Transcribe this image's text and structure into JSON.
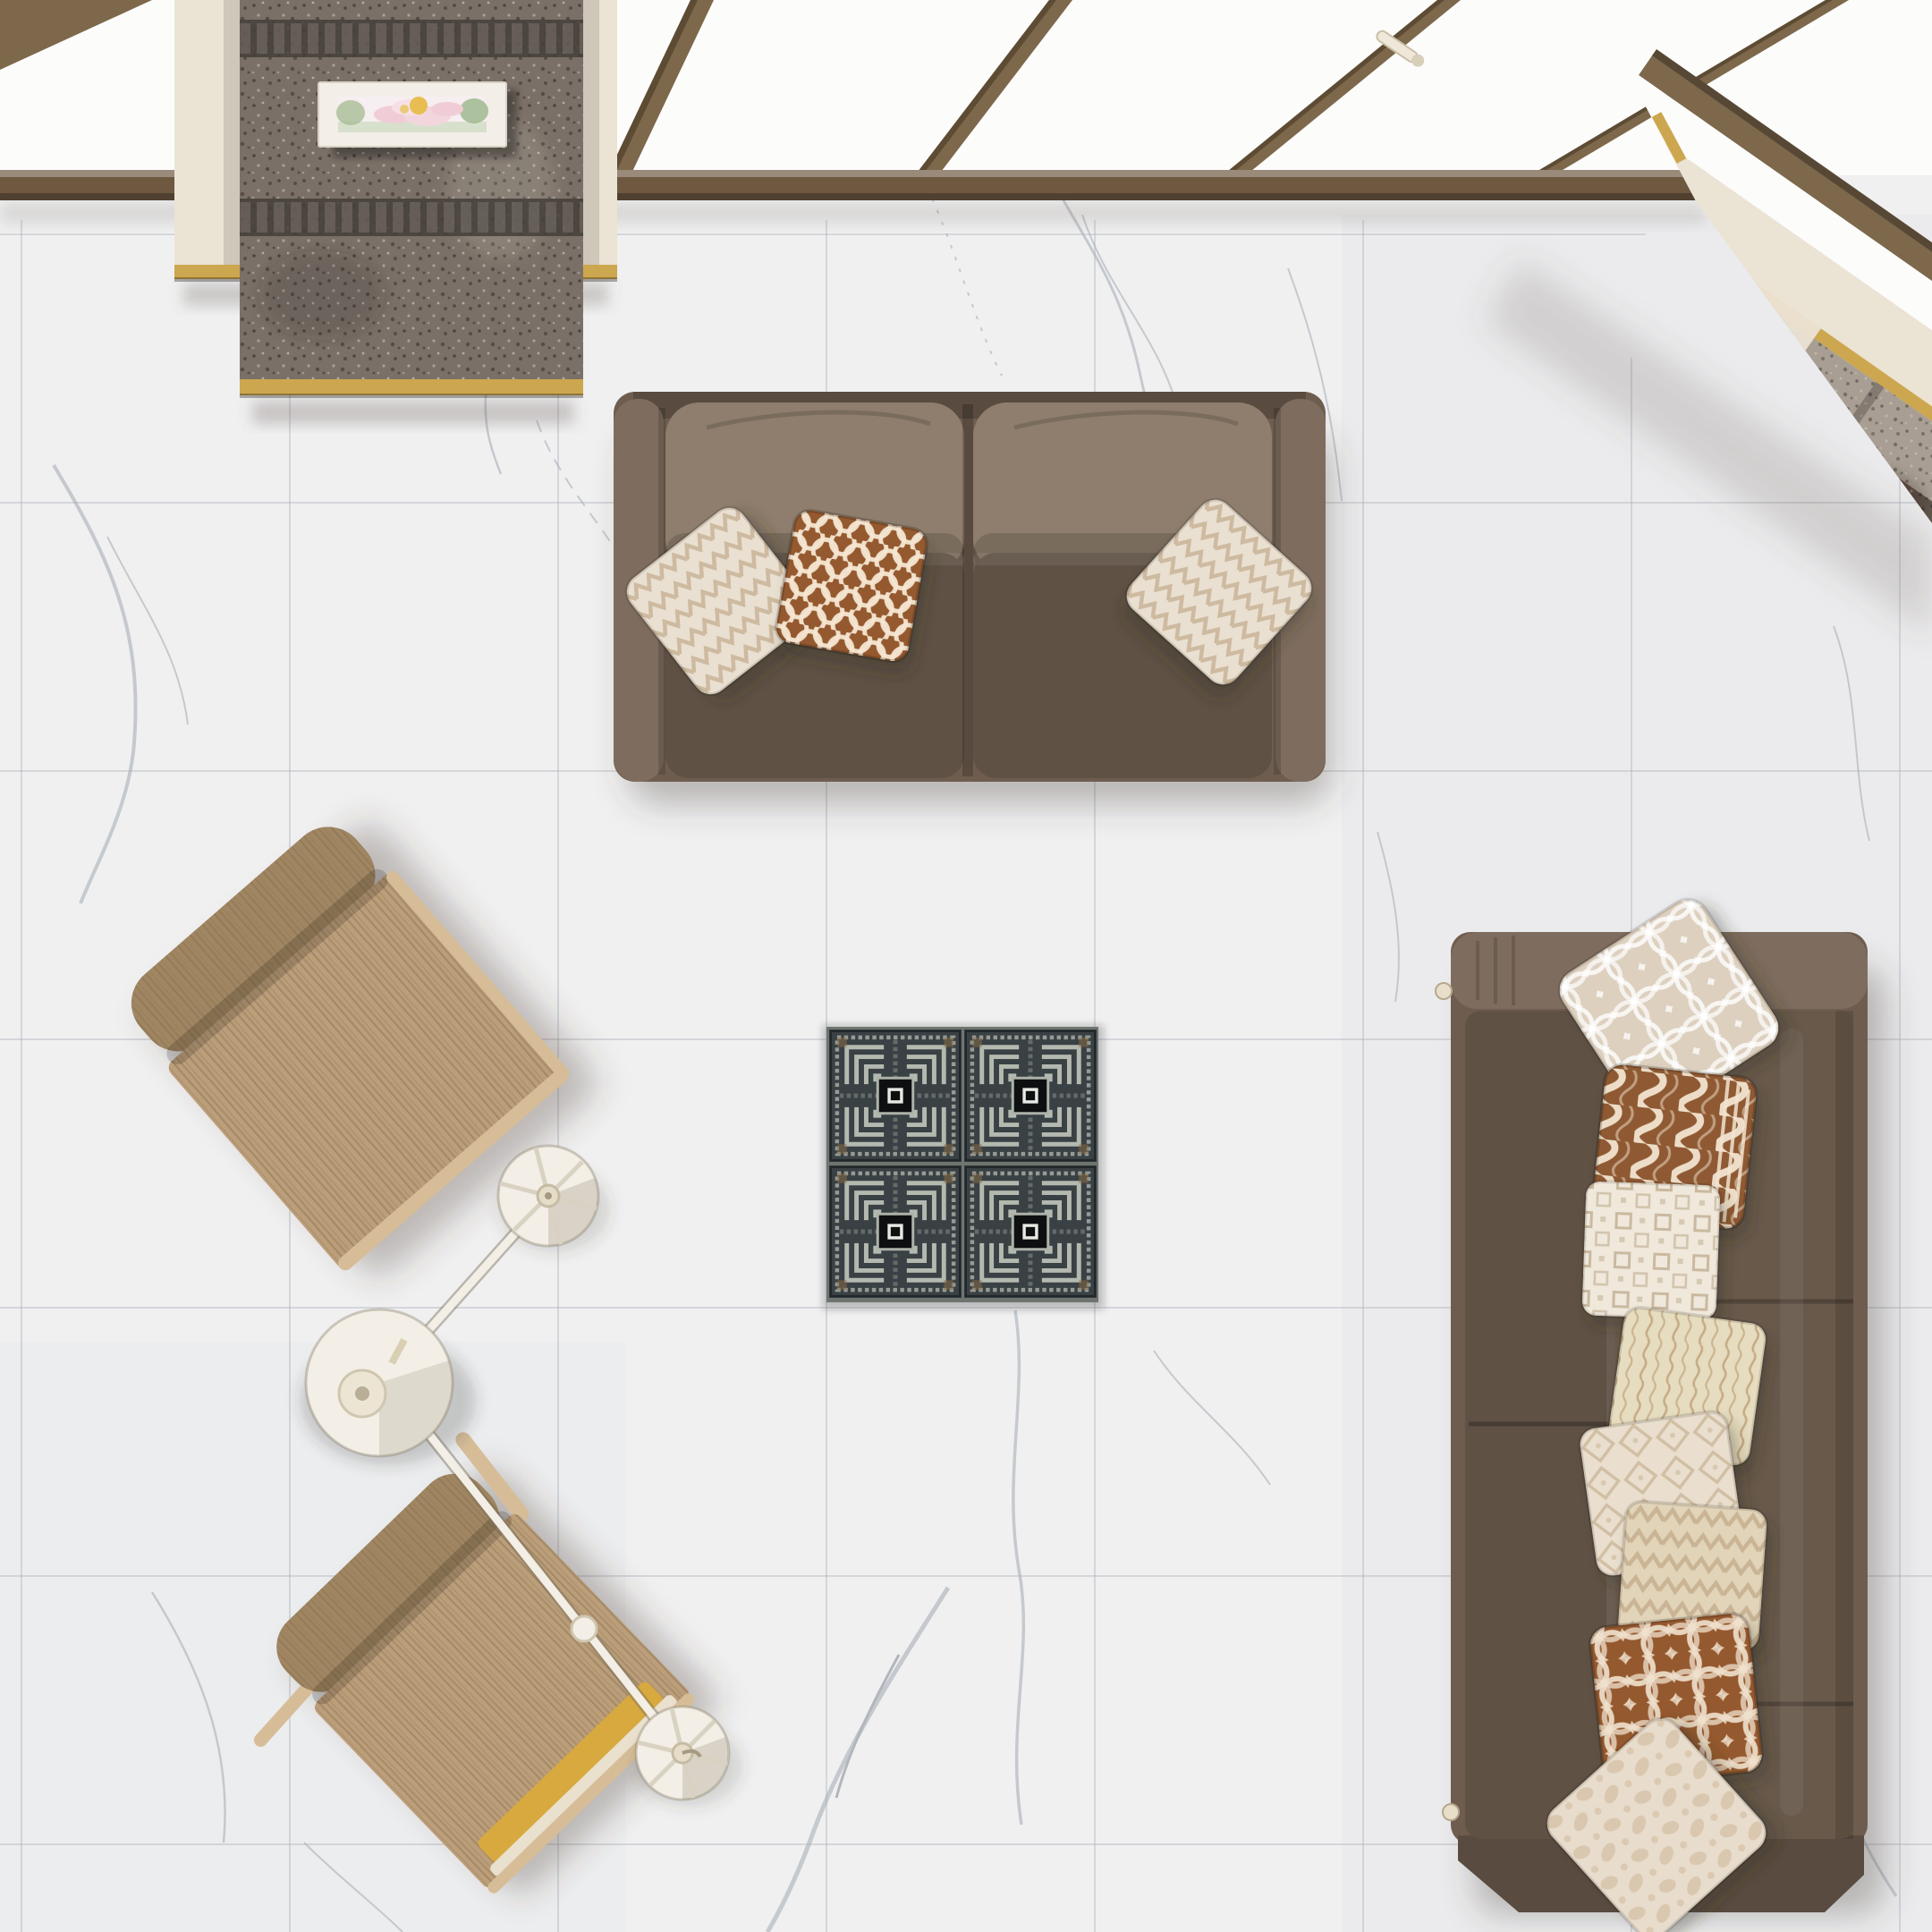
{
  "scene": {
    "type": "interior-3d-render",
    "view": "top-down bird's-eye view",
    "description": "Top-down 3D render of a living room: white marble tile floor with grey veining, a brown two-seat sofa with three patterned pillows, a long brown sofa on the right stacked with eight patterned pillows, two light-oak lounge chairs, an articulated cream floor lamp with two disc shades, a 2x2 Greek-key mosaic tile inset in the floor, a skylight window band with wooden mullions, a stone-clad pillar with a framed pink flower picture, and a stepped stone ledge in the top-right corner."
  },
  "colors": {
    "floor": "#f0f0f1",
    "floor-shade": "#e7e8ea",
    "grout": "#d6d8dc",
    "vein": "#a9b0b8",
    "vein-dark": "#8a9099",
    "glass": "#fcfcfb",
    "mullion": "#7d684c",
    "mullion-dark": "#55432d",
    "sill": "#6e5840",
    "cream": "#ebe3d4",
    "gold": "#cda74f",
    "granite": "#7b7067",
    "granite-dark": "#443e3a",
    "stone-grey": "#a89e93",
    "stone-dark": "#60564c",
    "sofa": "#6e5d4f",
    "sofa-light": "#7e6d5e",
    "sofa-dark": "#594b3f",
    "cushion-back": "#8f7e6d",
    "cushion-seat": "#5f5144",
    "wood": "#bb9e7a",
    "wood-light": "#d6bd98",
    "wood-dark": "#a08662",
    "chair-gold": "#d7a93e",
    "lamp": "#f3efe6",
    "lamp-line": "#d9d2c2",
    "pillow-cream": "#eae0d1",
    "pillow-beige": "#ddd0bf",
    "pillow-brown": "#95592f",
    "pillow-sand": "#e6dcc0",
    "tile-bg": "#33383a",
    "tile-pattern": "#aeb3ab",
    "tile-black": "#0e0f11",
    "tile-grout": "#6e746f"
  },
  "objects": [
    {
      "id": "marble-floor",
      "label": "White marble tile floor",
      "details": "large square tiles, grey veining, thin grout lines"
    },
    {
      "id": "skylight",
      "label": "Skylight window band",
      "details": "white glazing with slanted wooden mullions, dark wood sill, cream latch handle"
    },
    {
      "id": "stone-pillar",
      "label": "Stone-clad pillar",
      "details": "speckled grey stone column with dark banded courses, cream side panels, brass base trims"
    },
    {
      "id": "flower-picture",
      "label": "Framed flower artwork",
      "details": "white frame, pink lotus blossoms with yellow centers and green leaves"
    },
    {
      "id": "stone-steps",
      "label": "Stepped stone ledge, top-right corner",
      "details": "wood beam, cream fascia with brass trim, light and dark speckled stone courses"
    },
    {
      "id": "mosaic-inset",
      "label": "Greek-key mosaic tile inset",
      "details": "2x2 dark slate tiles, silver meander pattern, black center squares"
    },
    {
      "id": "sofa-top",
      "label": "Two-seat brown fabric sofa",
      "pillows": [
        "cream chevron",
        "terracotta scallop",
        "cream chevron"
      ]
    },
    {
      "id": "sofa-right",
      "label": "Long brown fabric sofa",
      "pillows": [
        "cream interlocking rings",
        "caramel cable knit",
        "cream greek squares",
        "beige wavy lines",
        "cream diamond trellis",
        "beige chevron",
        "caramel circle links",
        "cream damask"
      ]
    },
    {
      "id": "chair-upper",
      "label": "Light oak lounge chair",
      "details": "rolled backrest, visible wood grain"
    },
    {
      "id": "chair-lower",
      "label": "Light oak lounge chair",
      "details": "rolled backrest, gold seat cushion, thin wooden arm"
    },
    {
      "id": "floor-lamp",
      "label": "Articulated floor lamp",
      "details": "large cream base disc, jointed arms, two spoked disc shades"
    }
  ]
}
